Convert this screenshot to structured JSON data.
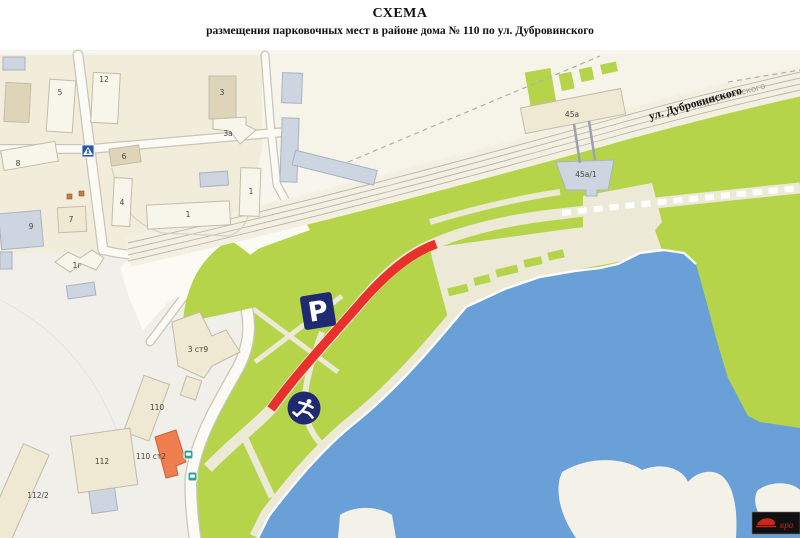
{
  "title": {
    "line1": "СХЕМА",
    "line2": "размещения парковочных мест в районе дома № 110 по ул. Дубровинского"
  },
  "map": {
    "street": {
      "label": "ул. Дубровинского",
      "ghost_label": "Дубровинского"
    },
    "parking_sign_letter": "P",
    "building_labels": [
      {
        "text": "5",
        "x": 60,
        "y": 95
      },
      {
        "text": "12",
        "x": 104,
        "y": 82
      },
      {
        "text": "3",
        "x": 222,
        "y": 95
      },
      {
        "text": "3а",
        "x": 228,
        "y": 136
      },
      {
        "text": "6",
        "x": 124,
        "y": 159
      },
      {
        "text": "8",
        "x": 18,
        "y": 166
      },
      {
        "text": "4",
        "x": 122,
        "y": 205
      },
      {
        "text": "1",
        "x": 188,
        "y": 217
      },
      {
        "text": "1",
        "x": 251,
        "y": 194
      },
      {
        "text": "7",
        "x": 71,
        "y": 222
      },
      {
        "text": "9",
        "x": 31,
        "y": 229
      },
      {
        "text": "1г",
        "x": 77,
        "y": 268
      },
      {
        "text": "3 ст9",
        "x": 198,
        "y": 352
      },
      {
        "text": "110",
        "x": 157,
        "y": 410
      },
      {
        "text": "110 ст2",
        "x": 151,
        "y": 459
      },
      {
        "text": "112",
        "x": 102,
        "y": 464
      },
      {
        "text": "112/2",
        "x": 38,
        "y": 498
      },
      {
        "text": "45а",
        "x": 572,
        "y": 117
      },
      {
        "text": "45а/1",
        "x": 586,
        "y": 177
      }
    ],
    "icons": {
      "parking_sign": "parking-sign-icon",
      "runner": "runner-icon",
      "pedestrian_crossing": "pedestrian-crossing-icon",
      "bus_stop": "bus-stop-icon"
    },
    "colors": {
      "park_green": "#b5d44a",
      "water_blue": "#6aa0d8",
      "parking_red": "#e7312a",
      "sign_navy": "#1f2a72",
      "transit_teal": "#2ba39c",
      "urban_beige": "#f2ecdb"
    }
  },
  "watermark": {
    "text": "кра"
  }
}
